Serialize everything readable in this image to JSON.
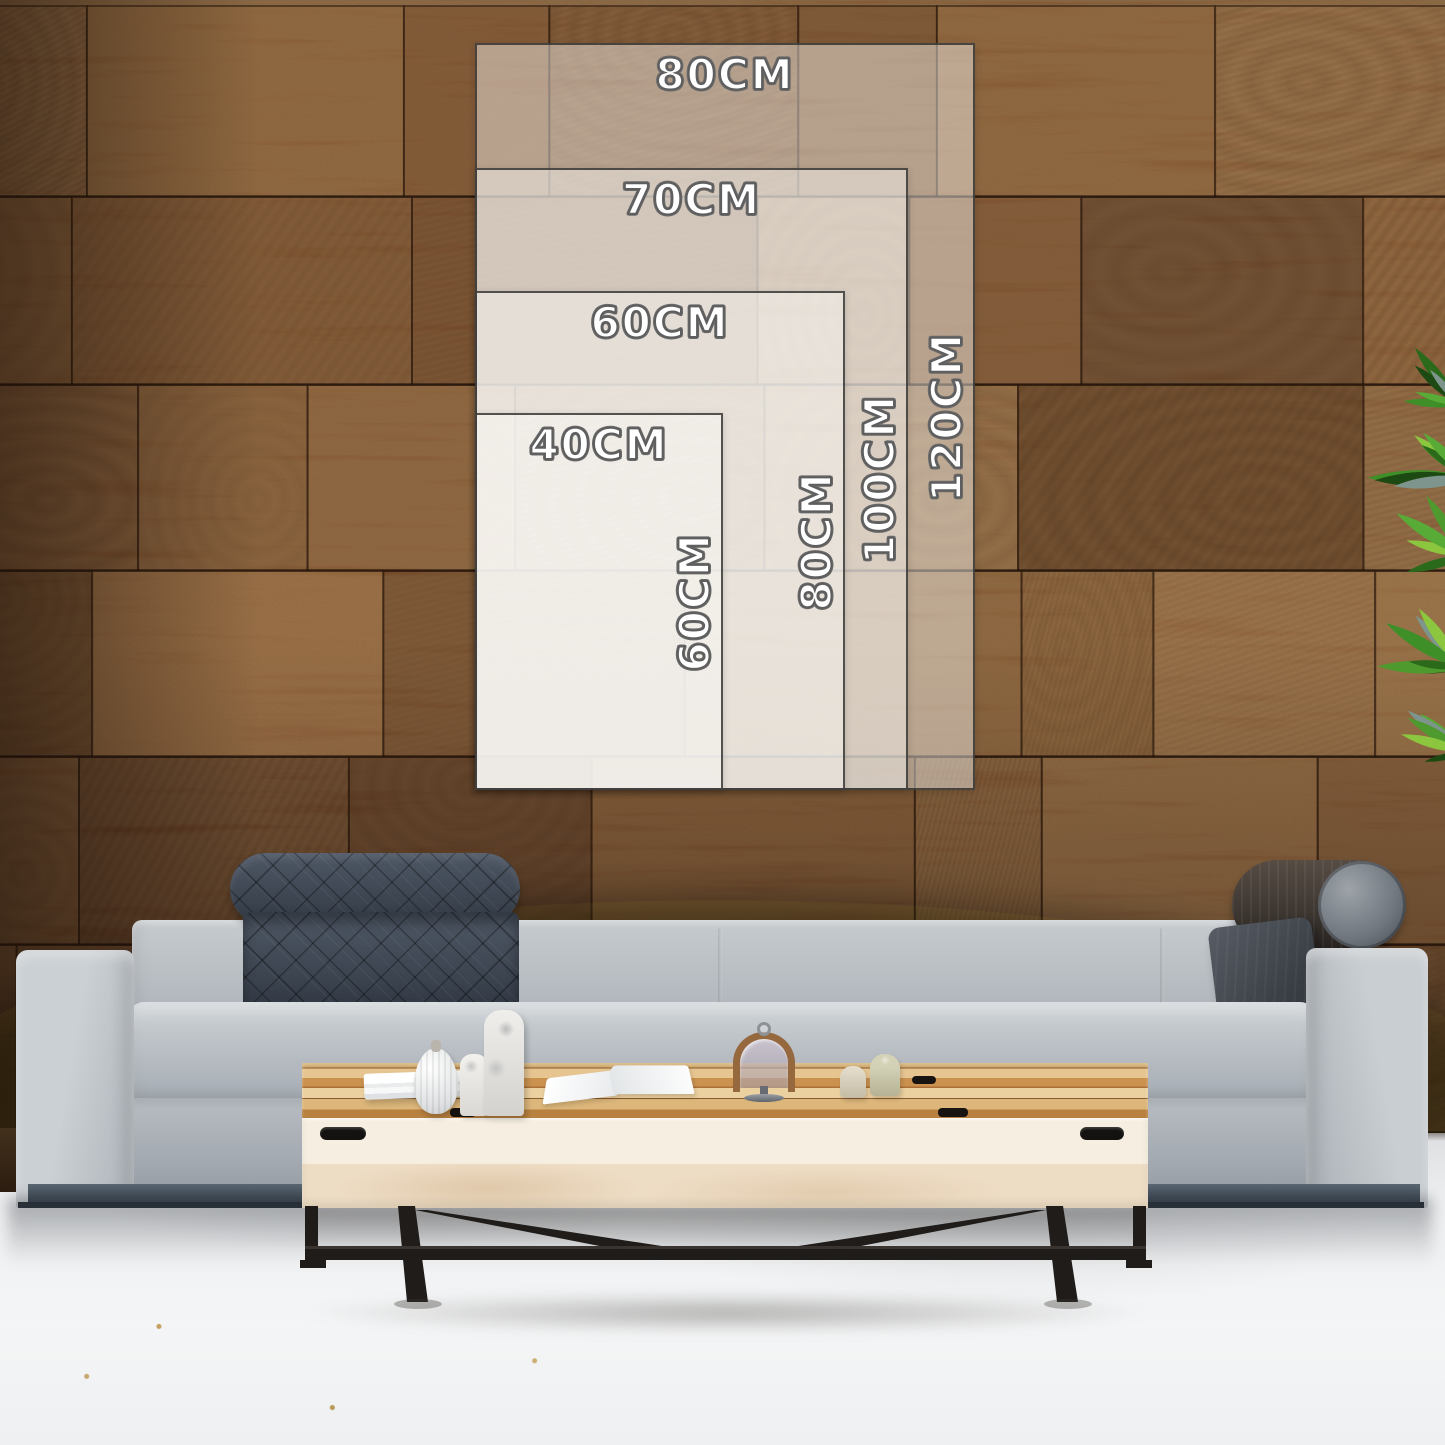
{
  "size_guide": {
    "unit": "CM",
    "orientation": "portrait",
    "sizes": [
      {
        "width_label": "80CM",
        "height_label": "120CM",
        "width_cm": 80,
        "height_cm": 120
      },
      {
        "width_label": "70CM",
        "height_label": "100CM",
        "width_cm": 70,
        "height_cm": 100
      },
      {
        "width_label": "60CM",
        "height_label": "80CM",
        "width_cm": 60,
        "height_cm": 80
      },
      {
        "width_label": "40CM",
        "height_label": "60CM",
        "width_cm": 40,
        "height_cm": 60
      }
    ]
  },
  "scene": {
    "wall": "end-grain-wood-block-wall",
    "floor": "light-concrete-floor",
    "sofa": "gray-fabric-sofa",
    "coffee_table": "light-wood-coffee-table",
    "plant": "green-plant",
    "tabletop_items": [
      "book-stack",
      "ribbed-vase",
      "marble-bottle-vases",
      "open-book",
      "glass-cloche",
      "ceramic-jars"
    ]
  },
  "colors": {
    "overlay_fill": "rgba(255,255,255,0.44)",
    "overlay_border": "#302e2c",
    "label_fill": "#ffffff",
    "label_outline": "#5e5e5e",
    "wall_base": "#7b4c2a",
    "sofa_fabric": "#b0b6bc",
    "cushion_quilted": "#434c59",
    "table_wood": "#d9b277",
    "floor": "#eef0f1"
  }
}
